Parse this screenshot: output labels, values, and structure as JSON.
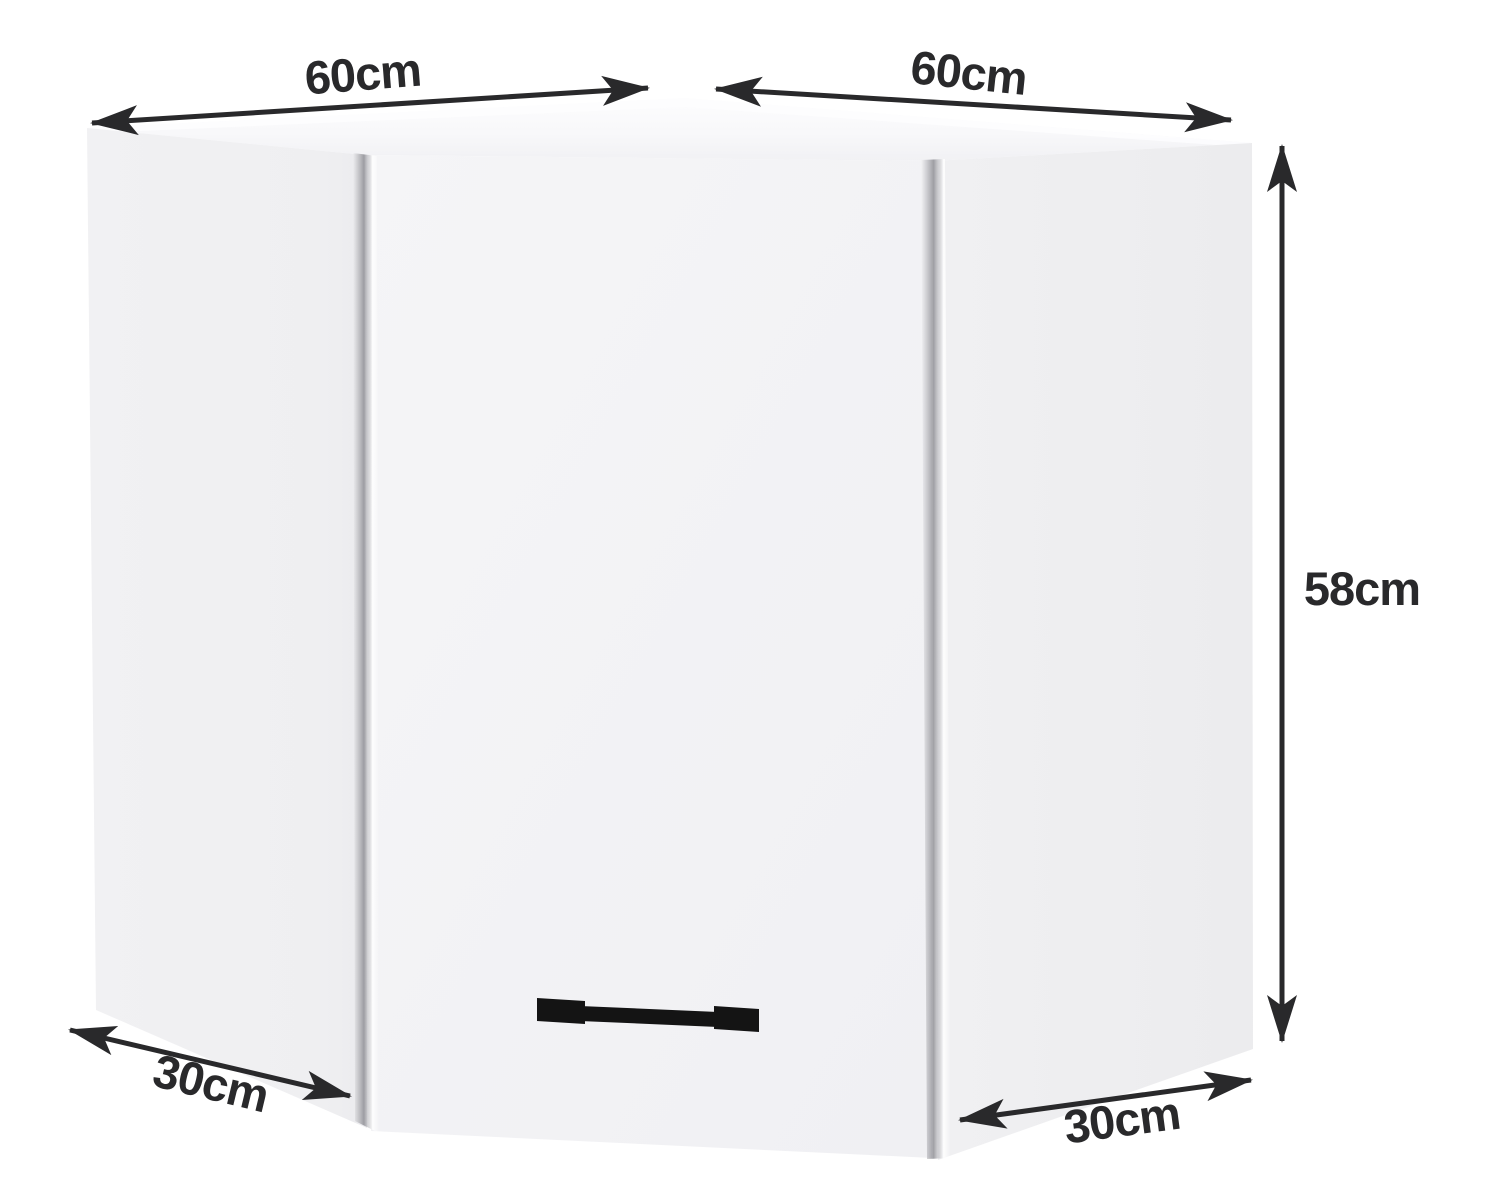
{
  "diagram": {
    "unit": "cm",
    "dimensions": {
      "top_left_width": {
        "label": "60cm",
        "value": 60
      },
      "top_right_width": {
        "label": "60cm",
        "value": 60
      },
      "height": {
        "label": "58cm",
        "value": 58
      },
      "bottom_left_depth": {
        "label": "30cm",
        "value": 30
      },
      "bottom_right_depth": {
        "label": "30cm",
        "value": 30
      }
    },
    "colors": {
      "arrow": "#29292b",
      "label_text": "#29292b",
      "cabinet_panel": "#f0f0f2",
      "cabinet_door": "#f3f3f5",
      "cabinet_top": "#fafafc",
      "handle": "#141414",
      "background": "#ffffff"
    }
  }
}
